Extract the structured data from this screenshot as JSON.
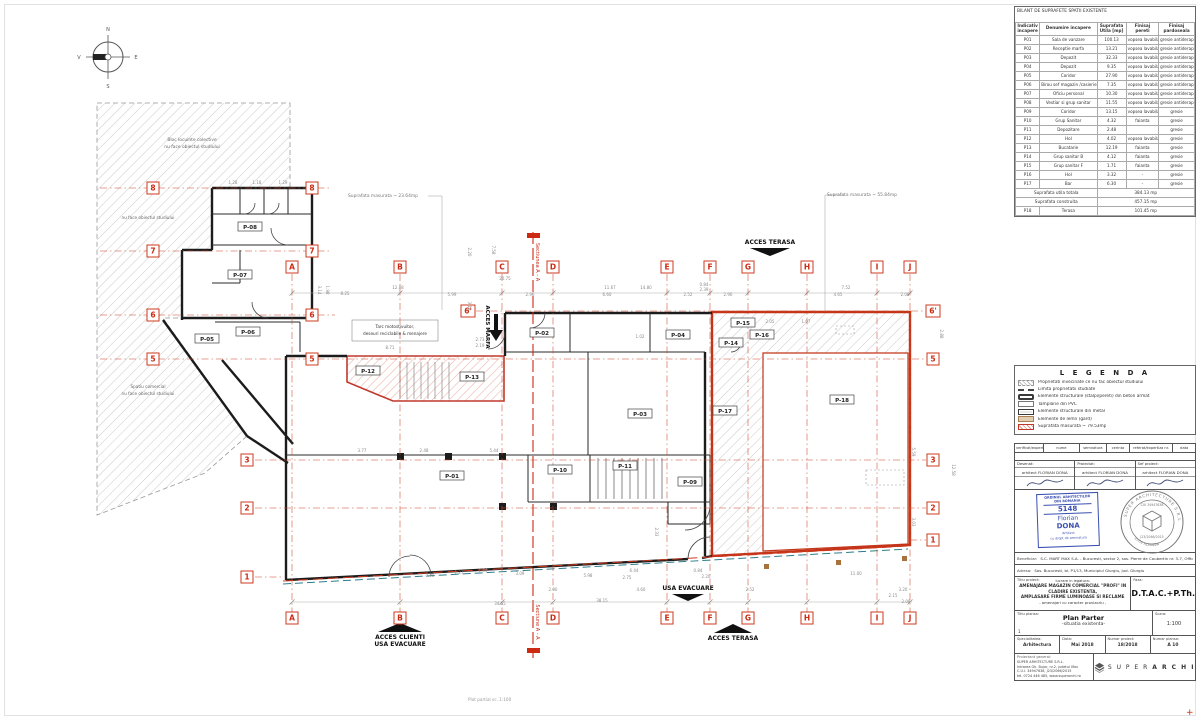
{
  "sheet": {
    "footer_note": "Plot partial sc. 1:100"
  },
  "compass": {
    "n": "N",
    "e": "E",
    "s": "S",
    "v": "V"
  },
  "plan": {
    "neighbor_top": [
      "Bloc locuinte colective",
      "nu face obiectul studiului"
    ],
    "neighbor_mid": "nu face obiectul studiului",
    "neighbor_bottom": [
      "Spatiu comercial",
      "nu face obiectul studiului"
    ],
    "tarc_note": [
      "Tarc motostivuitor,",
      "deseuri reciclabile & menajere"
    ],
    "area_note_left": "Suprafata masurata ~ 23.64mp",
    "area_note_right": "Suprafata masurata ~ 55.84mp",
    "access": {
      "terasa_top": "ACCES TERASA",
      "marfa": "ACCES MARFA",
      "evacuare": "USA EVACUARE",
      "clienti1": "ACCES CLIENTI",
      "clienti2": "USA EVACUARE",
      "terasa_bottom": "ACCES TERASA"
    },
    "sections": {
      "top": "Sectiunea A - A",
      "bottom": "Sectiune A - A"
    },
    "grid_cols": [
      {
        "l": "A",
        "x": 292
      },
      {
        "l": "B",
        "x": 400
      },
      {
        "l": "C",
        "x": 502
      },
      {
        "l": "D",
        "x": 553
      },
      {
        "l": "E",
        "x": 667
      },
      {
        "l": "F",
        "x": 710
      },
      {
        "l": "G",
        "x": 748
      },
      {
        "l": "H",
        "x": 807
      },
      {
        "l": "I",
        "x": 877
      },
      {
        "l": "J",
        "x": 910
      }
    ],
    "grid_rows": [
      {
        "l": "8",
        "y": 188,
        "xs": [
          153,
          312
        ],
        "line": [
          100,
          330
        ]
      },
      {
        "l": "7",
        "y": 251,
        "xs": [
          153,
          312
        ],
        "line": [
          100,
          330
        ]
      },
      {
        "l": "6",
        "y": 315,
        "xs": [
          153,
          312
        ],
        "line": [
          100,
          335
        ]
      },
      {
        "l": "5",
        "y": 359,
        "xs": [
          153,
          312,
          933
        ],
        "line": [
          100,
          926
        ]
      },
      {
        "l": "6'",
        "y": 311,
        "xs": [
          468,
          933
        ],
        "line": [
          476,
          926
        ]
      },
      {
        "l": "3",
        "y": 460,
        "xs": [
          247,
          933
        ],
        "line": [
          255,
          926
        ]
      },
      {
        "l": "2",
        "y": 508,
        "xs": [
          247,
          933
        ],
        "line": [
          255,
          926
        ]
      },
      {
        "l": "1",
        "y": 577,
        "xs": [
          247
        ],
        "line": [
          255,
          284
        ]
      },
      {
        "l": "1",
        "y": 540,
        "xs": [
          933
        ],
        "line": [
          910,
          926
        ]
      }
    ],
    "rooms": [
      {
        "id": "P-01",
        "x": 452,
        "y": 477
      },
      {
        "id": "P-02",
        "x": 542,
        "y": 334
      },
      {
        "id": "P-03",
        "x": 640,
        "y": 415
      },
      {
        "id": "P-04",
        "x": 678,
        "y": 336
      },
      {
        "id": "P-05",
        "x": 207,
        "y": 340
      },
      {
        "id": "P-06",
        "x": 248,
        "y": 333
      },
      {
        "id": "P-07",
        "x": 240,
        "y": 276
      },
      {
        "id": "P-08",
        "x": 250,
        "y": 228
      },
      {
        "id": "P-09",
        "x": 690,
        "y": 483
      },
      {
        "id": "P-10",
        "x": 560,
        "y": 471
      },
      {
        "id": "P-11",
        "x": 625,
        "y": 467
      },
      {
        "id": "P-12",
        "x": 368,
        "y": 372
      },
      {
        "id": "P-13",
        "x": 472,
        "y": 378
      },
      {
        "id": "P-14",
        "x": 731,
        "y": 344
      },
      {
        "id": "P-15",
        "x": 743,
        "y": 324
      },
      {
        "id": "P-16",
        "x": 762,
        "y": 336
      },
      {
        "id": "P-17",
        "x": 725,
        "y": 412
      },
      {
        "id": "P-18",
        "x": 842,
        "y": 401
      }
    ],
    "dims": [
      [
        "1.28",
        233,
        184,
        0
      ],
      [
        "1.18",
        257,
        184,
        0
      ],
      [
        "1.29",
        283,
        184,
        0
      ],
      [
        "8.25",
        345,
        295,
        0
      ],
      [
        "12.88",
        398,
        289,
        0
      ],
      [
        "5.99",
        452,
        296,
        0
      ],
      [
        "20.75",
        505,
        280,
        0
      ],
      [
        "2.96",
        530,
        296,
        0
      ],
      [
        "11.67",
        610,
        289,
        0
      ],
      [
        "14.80",
        646,
        289,
        0
      ],
      [
        "6.60",
        607,
        296,
        0
      ],
      [
        "2.52",
        688,
        296,
        0
      ],
      [
        "2.90",
        728,
        296,
        0
      ],
      [
        "0.84",
        704,
        286,
        0
      ],
      [
        "2.39",
        704,
        291,
        0
      ],
      [
        "7.52",
        846,
        289,
        0
      ],
      [
        "4.65",
        838,
        296,
        0
      ],
      [
        "2.08",
        905,
        296,
        0
      ],
      [
        "8.71",
        390,
        349,
        0
      ],
      [
        "2.73",
        480,
        341,
        0
      ],
      [
        "2.19",
        480,
        347,
        0
      ],
      [
        "1.02",
        640,
        338,
        0
      ],
      [
        "2.05",
        770,
        323,
        0
      ],
      [
        "1.07",
        806,
        323,
        0
      ],
      [
        "3.77",
        362,
        452,
        0
      ],
      [
        "5.44",
        494,
        452,
        0
      ],
      [
        "2.48",
        424,
        452,
        0
      ],
      [
        "3.14",
        318,
        290,
        90
      ],
      [
        "1.98",
        326,
        290,
        90
      ],
      [
        "2.20",
        468,
        252,
        90
      ],
      [
        "7.58",
        492,
        250,
        90
      ],
      [
        "3.18",
        468,
        306,
        90
      ],
      [
        "2.88",
        940,
        334,
        90
      ],
      [
        "5.59",
        912,
        452,
        90
      ],
      [
        "12.58",
        952,
        470,
        90
      ],
      [
        "3.03",
        912,
        522,
        90
      ],
      [
        "2.33",
        655,
        532,
        90
      ],
      [
        "6.44",
        634,
        572,
        0
      ],
      [
        "2.75",
        627,
        579,
        0
      ],
      [
        "0.84",
        698,
        572,
        0
      ],
      [
        "2.20",
        706,
        578,
        0
      ],
      [
        "5.98",
        588,
        577,
        0
      ],
      [
        "3.09",
        520,
        575,
        0
      ],
      [
        "1.84",
        483,
        572,
        0
      ],
      [
        "1.27",
        459,
        574,
        0
      ],
      [
        "0.70",
        430,
        577,
        0
      ],
      [
        "34.55",
        500,
        605,
        0
      ],
      [
        "38.15",
        602,
        602,
        0
      ],
      [
        "2.80",
        553,
        591,
        0
      ],
      [
        "4.60",
        641,
        591,
        0
      ],
      [
        "2.52",
        750,
        591,
        0
      ],
      [
        "3.20",
        903,
        591,
        0
      ],
      [
        "2.08",
        906,
        603,
        0
      ],
      [
        "11.00",
        856,
        575,
        0
      ],
      [
        "2.15",
        893,
        597,
        0
      ]
    ]
  },
  "surface_table": {
    "title": "BILANT DE SUPRAFETE SPATII EXISTENTE",
    "headers": [
      "Indicativ incapere",
      "Denumire incapere",
      "Suprafata Utila [mp]",
      "Finisaj pereti",
      "Finisaj pardoseala"
    ],
    "rows": [
      [
        "P01",
        "Sala de vanzare",
        "100.13",
        "vopsea lavabila",
        "gresie antiderapanta"
      ],
      [
        "P02",
        "Receptie marfa",
        "13.21",
        "vopsea lavabila",
        "gresie antiderapanta"
      ],
      [
        "P03",
        "Depozit",
        "32.33",
        "vopsea lavabila",
        "gresie antiderapanta"
      ],
      [
        "P04",
        "Depozit",
        "9.35",
        "vopsea lavabila",
        "gresie antiderapanta"
      ],
      [
        "P05",
        "Coridor",
        "27.90",
        "vopsea lavabila",
        "gresie antiderapanta"
      ],
      [
        "P06",
        "Birou sef magazin /casierie",
        "7.35",
        "vopsea lavabila",
        "gresie antiderapanta"
      ],
      [
        "P07",
        "Oficiu personal",
        "10.30",
        "vopsea lavabila",
        "gresie antiderapanta"
      ],
      [
        "P08",
        "Vestiar si grup sanitar",
        "11.55",
        "vopsea lavabila /faianta",
        "gresie antiderapanta"
      ],
      [
        "P09",
        "Coridor",
        "13.15",
        "vopsea lavabila",
        "gresie"
      ],
      [
        "P10",
        "Grup Sanitar",
        "4.32",
        "faianta",
        "gresie"
      ],
      [
        "P11",
        "Depozitare",
        "2.48",
        "",
        "gresie"
      ],
      [
        "P12",
        "Hol",
        "4.02",
        "vopsea lavabila",
        "gresie"
      ],
      [
        "P13",
        "Bucatarie",
        "12.19",
        "faianta",
        "gresie"
      ],
      [
        "P14",
        "Grup sanitar B",
        "4.12",
        "faianta",
        "gresie"
      ],
      [
        "P15",
        "Grup sanitar F",
        "1.71",
        "faianta",
        "gresie"
      ],
      [
        "P16",
        "Hol",
        "3.32",
        "-",
        "gresie"
      ],
      [
        "P17",
        "Bar",
        "6.30",
        "-",
        "gresie"
      ]
    ],
    "totals": [
      {
        "label": "Suprafata utila totala",
        "value": "384.13 mp"
      },
      {
        "label": "Suprafata construita",
        "value": "457.15 mp"
      }
    ],
    "terrace": {
      "id": "P18",
      "name": "Terasa",
      "value": "101.45 mp"
    }
  },
  "legend": {
    "title": "L E G E N D A",
    "items": [
      {
        "type": "hatch-gray",
        "label": "Proprietati invecinate ce nu fac obiectul studiului"
      },
      {
        "type": "dash-line",
        "label": "Limita proprietatii studiate"
      },
      {
        "type": "concrete",
        "label": "Elemente structurale (stalpi/pereti) din beton armat"
      },
      {
        "type": "pvc",
        "label": "Tamplarie din PVC"
      },
      {
        "type": "metal",
        "label": "Elemente structurale din metal"
      },
      {
        "type": "wood",
        "label": "Elemente de lemn (gard)"
      },
      {
        "type": "hatch-red",
        "label": "Suprafata masurata ~ 79.53mp"
      }
    ]
  },
  "titleblock": {
    "verif_headers": [
      "verificat/expert",
      "nume",
      "semnatura",
      "cerinta",
      "referat/expertiza nr.",
      "data"
    ],
    "roles": [
      {
        "label": "Desenat:",
        "name": "arhitect FLORIAN DONA"
      },
      {
        "label": "Proiectat:",
        "name": "arhitect FLORIAN DONA"
      },
      {
        "label": "Sef proiect:",
        "name": "arhitect FLORIAN DONA"
      }
    ],
    "oar_stamp": {
      "line1": "ORDINUL ARHITECTILOR",
      "line2": "DIN ROMANIA",
      "number": "5148",
      "first": "Florian",
      "last": "DONA",
      "role": "Arhitect",
      "note": "cu drept de semnatura"
    },
    "round_stamp": {
      "top": "SUPER ARCHITECTURE S.R.L.",
      "cui": "CUI 34947638",
      "reg": "J23/2066/2015",
      "bottom": "ILFOV ROMANIA"
    },
    "beneficiar": {
      "label": "Beneficiar:",
      "value": "S.C. MART MAX S.A. - Bucuresti, sector 2, sos. Pierre de Coubertin nr. 3-7, Office Building"
    },
    "adresa": {
      "label": "Adresa:",
      "value": "Sos. Bucuresti, bl. P1/13, Municipiul Giurgiu, Jud. Giurgiu"
    },
    "proiect": {
      "label": "Titlu proiect:",
      "sub": "lucrare in legatura:",
      "line1": "AMENAJARE MAGAZIN COMERCIAL \"PROFI\" IN CLADIRE EXISTENTA,",
      "line2": "AMPLASARE FIRME LUMINOASE SI RECLAME",
      "line3": "- amenajari cu caracter provizoriu -"
    },
    "faza": {
      "label": "Faza:",
      "value": "D.T.A.C.+P.Th."
    },
    "plansa": {
      "label": "Titlu plansa:",
      "line1": "Plan Parter",
      "line2": "-situatia existenta-",
      "index": "1",
      "scara_label": "Scara:",
      "scara": "1:100"
    },
    "specs": [
      {
        "label": "Specialitatea:",
        "value": "Arhitectura"
      },
      {
        "label": "Data:",
        "value": "Mai 2018"
      },
      {
        "label": "Numar proiect:",
        "value": "18/2018"
      },
      {
        "label": "Numar plansa:",
        "value": "A 10"
      }
    ],
    "proiectant": {
      "label": "Proiectant general:",
      "lines": [
        "SUPER ARHITECTURE S.R.L.",
        "Intrarea Gh. Bujor, nr.2, judetul Ilfov",
        "C.U.I. 34947638, J23/2066/2015",
        "tel. 0724 446 485, www.superarchi.ro"
      ]
    },
    "logo": {
      "word1": "S U P E R",
      "word2": "A R C H I"
    }
  }
}
